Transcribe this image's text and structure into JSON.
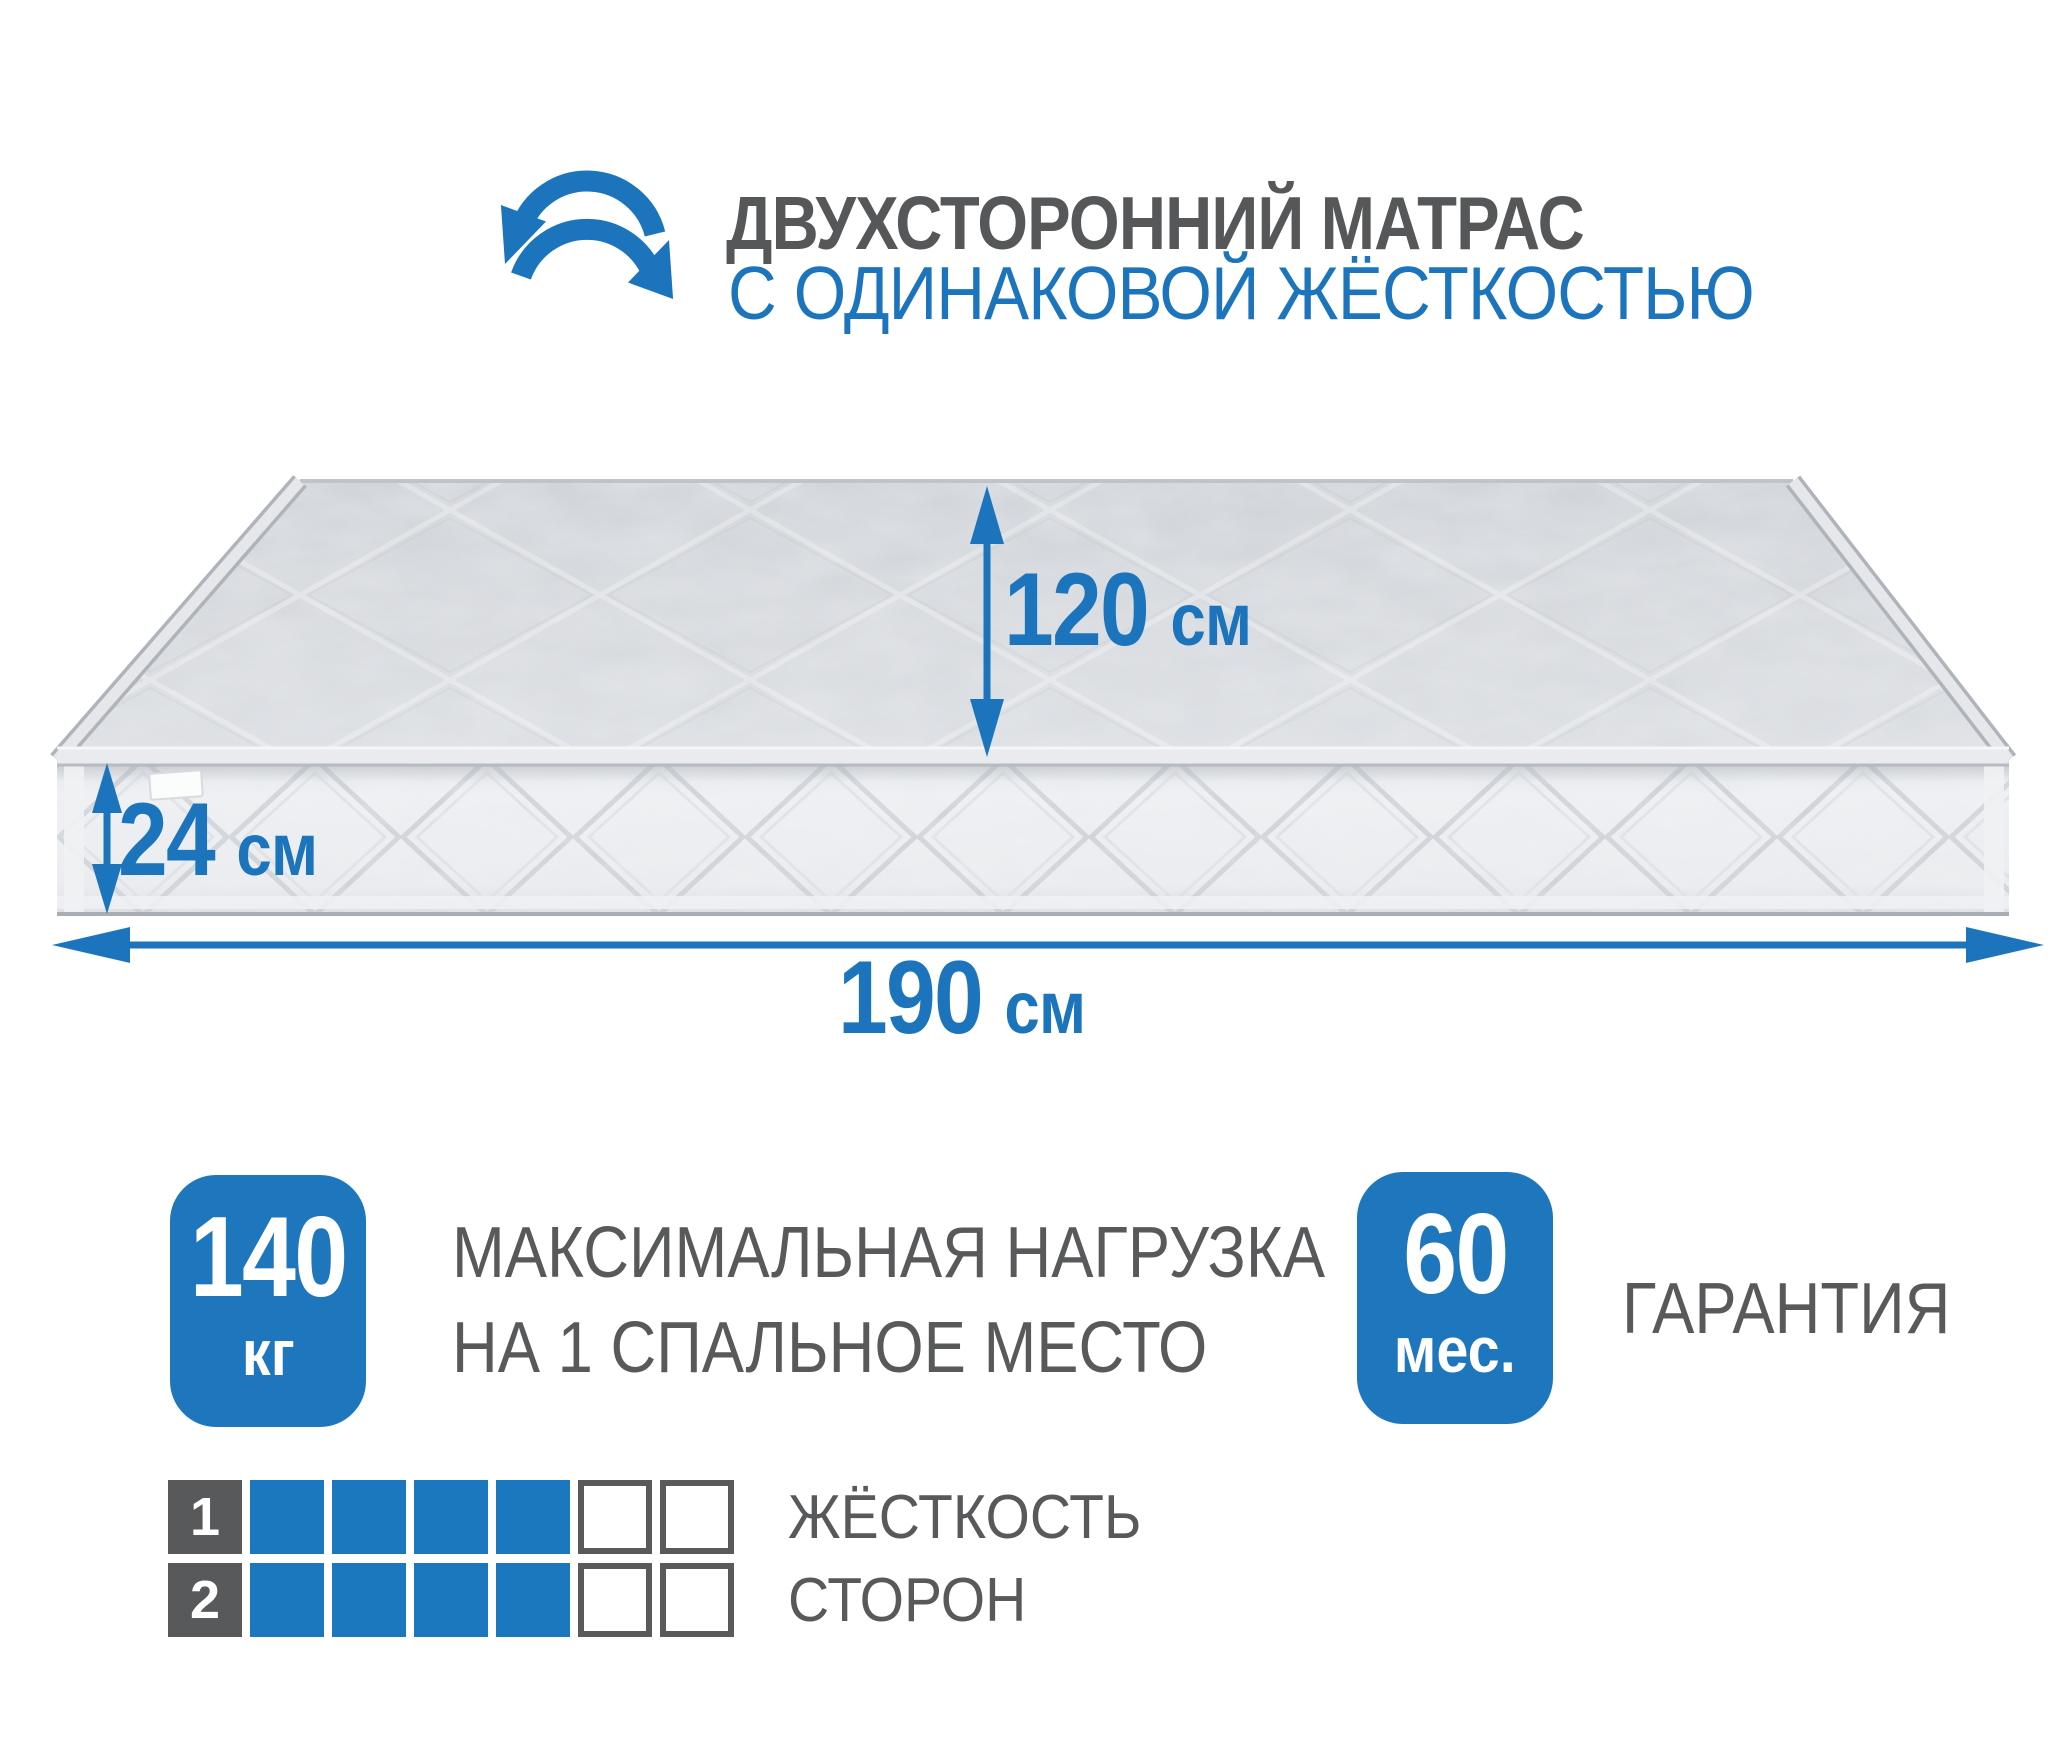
{
  "colors": {
    "accent_blue": "#1C75BC",
    "badge_blue": "#1E76BC",
    "grid_blue": "#1B77BE",
    "text_gray": "#58595B",
    "mattress_top": "#D3D6DA",
    "mattress_front": "#EAECEF"
  },
  "header": {
    "icon": "rotate-arrows-icon",
    "title": "ДВУХСТОРОННИЙ МАТРАС",
    "subtitle": "С ОДИНАКОВОЙ ЖЁСТКОСТЬЮ"
  },
  "dimensions": {
    "depth": {
      "value": "120",
      "unit": "см"
    },
    "height": {
      "value": "24",
      "unit": "см"
    },
    "length": {
      "value": "190",
      "unit": "см"
    }
  },
  "badges": {
    "max_load": {
      "value": "140",
      "unit": "кг",
      "label_line1": "МАКСИМАЛЬНАЯ НАГРУЗКА",
      "label_line2": "НА 1 СПАЛЬНОЕ МЕСТО"
    },
    "warranty": {
      "value": "60",
      "unit": "мес.",
      "label": "ГАРАНТИЯ"
    }
  },
  "hardness": {
    "label_line1": "ЖЁСТКОСТЬ",
    "label_line2": "СТОРОН",
    "scale_cells": 6,
    "rows": [
      {
        "num": "1",
        "filled": 4
      },
      {
        "num": "2",
        "filled": 4
      }
    ]
  }
}
